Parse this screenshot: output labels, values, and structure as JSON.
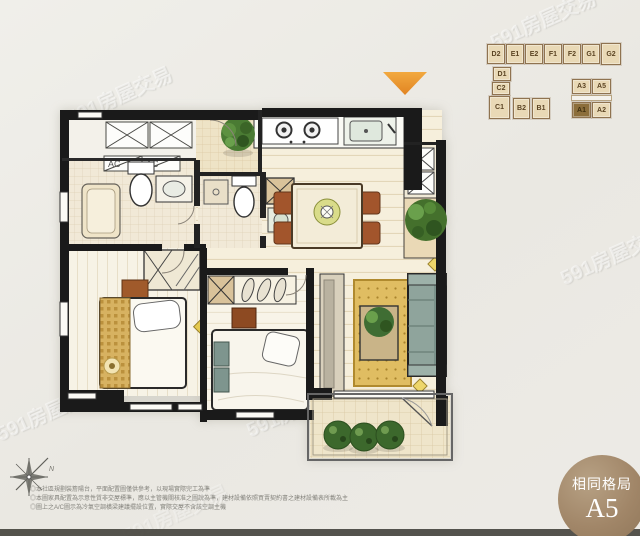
{
  "watermark": {
    "text": "591房屋交易"
  },
  "unit_map": {
    "highlighted_unit": "A1",
    "units": [
      {
        "label": "D2"
      },
      {
        "label": "E1"
      },
      {
        "label": "E2"
      },
      {
        "label": "F1"
      },
      {
        "label": "F2"
      },
      {
        "label": "G1"
      },
      {
        "label": "G2"
      },
      {
        "label": "D1"
      },
      {
        "label": "C2"
      },
      {
        "label": "C1"
      },
      {
        "label": "B2"
      },
      {
        "label": "B1"
      },
      {
        "label": "A3"
      },
      {
        "label": "A5"
      },
      {
        "label": "A1"
      },
      {
        "label": "A2"
      }
    ]
  },
  "floorplan": {
    "ac_labels": [
      "AC",
      "AC"
    ]
  },
  "compass": {
    "mark": "N"
  },
  "notes": [
    "◎本社區規劃裝簷陽台，平面配置圖僅供參考，以現場實際完工為準",
    "◎本圖家具配置為示意性質非交屋標準，應以主管機關核准之圖說為準，建材設備依照買賣契約書之建材設備表所載為主",
    "◎圖上之A/C圖示為冷氣空調橫梁建議擺設位置，實際交屋不含該空調主機"
  ],
  "badge": {
    "title": "相同格局",
    "unit": "A5"
  },
  "colors": {
    "marker_orange": "#e8912f",
    "badge_bg": "#a18668",
    "unit_box_fill": "#e9d9b6",
    "unit_highlight": "#8c6e3b",
    "wall_black": "#1a1a1a",
    "rug_gold": "#e0bd62",
    "sofa_teal": "#8fa49c",
    "plant_green": "#44702c"
  }
}
